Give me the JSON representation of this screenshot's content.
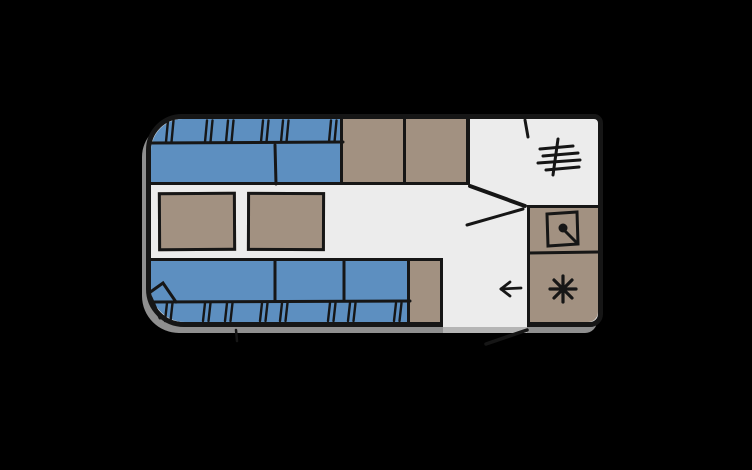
{
  "scene": {
    "label": "Caravan floor plan, top view",
    "type": "floorplan"
  },
  "colors": {
    "background": "#000000",
    "wall_line": "#161616",
    "floor": "#ececec",
    "cushion_blue": "#5d8fc0",
    "furniture_tan": "#a29181",
    "shadow_gray": "#8f8f8f",
    "threshold_gray": "#b5b5b5"
  },
  "rooms": [
    {
      "name": "front-lounge",
      "features": [
        "upper-bench-seat",
        "upper-bench-backrest",
        "lower-bench-seat",
        "lower-bench-backrest",
        "corner-seat-wedge",
        "table-left",
        "table-right"
      ]
    },
    {
      "name": "wardrobe",
      "features": [
        "cabinet-left",
        "cabinet-right"
      ]
    },
    {
      "name": "washroom",
      "features": [
        "heater",
        "washroom-door",
        "angled-partition-wall"
      ]
    },
    {
      "name": "kitchen",
      "features": [
        "sink-counter",
        "hob-counter"
      ]
    },
    {
      "name": "entrance",
      "features": [
        "entry-door-opening",
        "entry-door-leaf",
        "entry-direction-arrow"
      ]
    }
  ],
  "icons": [
    {
      "name": "heater-icon",
      "meaning": "blown-air heater / radiator fins"
    },
    {
      "name": "sink-icon",
      "meaning": "sink basin with tap"
    },
    {
      "name": "hob-burner-icon",
      "meaning": "gas hob burner"
    },
    {
      "name": "entry-arrow-icon",
      "meaning": "entrance direction arrow pointing left"
    }
  ]
}
